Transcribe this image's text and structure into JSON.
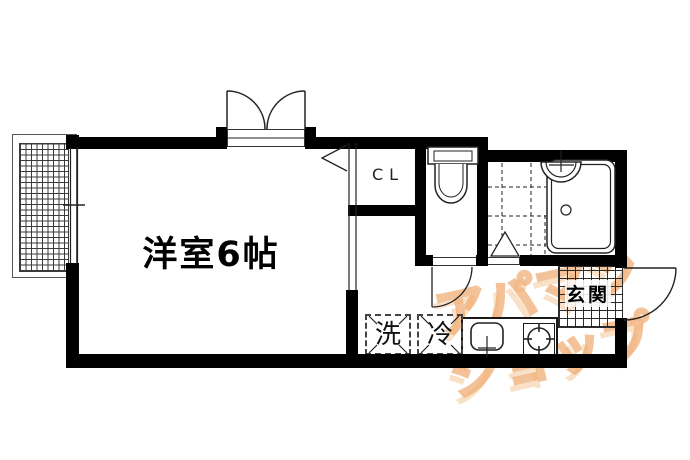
{
  "labels": {
    "main_room": "洋室6帖",
    "closet": "CL",
    "entrance": "玄関",
    "washer": "洗",
    "fridge": "冷"
  },
  "watermark": {
    "line1": "アパマン",
    "line2": "ショップ"
  },
  "colors": {
    "background": "#ffffff",
    "wall": "#000000",
    "line": "#222222",
    "watermark_stroke": "#eea363",
    "watermark_shadow": "#f4c99b"
  },
  "fixtures": [
    "balcony-grid",
    "balcony-window",
    "double-door-window",
    "sliding-partition",
    "opening-chevron",
    "closet",
    "toilet",
    "toilet-door",
    "bathroom-tile-floor",
    "bathroom-folding-door",
    "bathtub",
    "washbasin",
    "entrance-tile",
    "entrance-door",
    "kitchen-counter",
    "kitchen-sink",
    "stove-burner",
    "washer-space",
    "fridge-space"
  ]
}
